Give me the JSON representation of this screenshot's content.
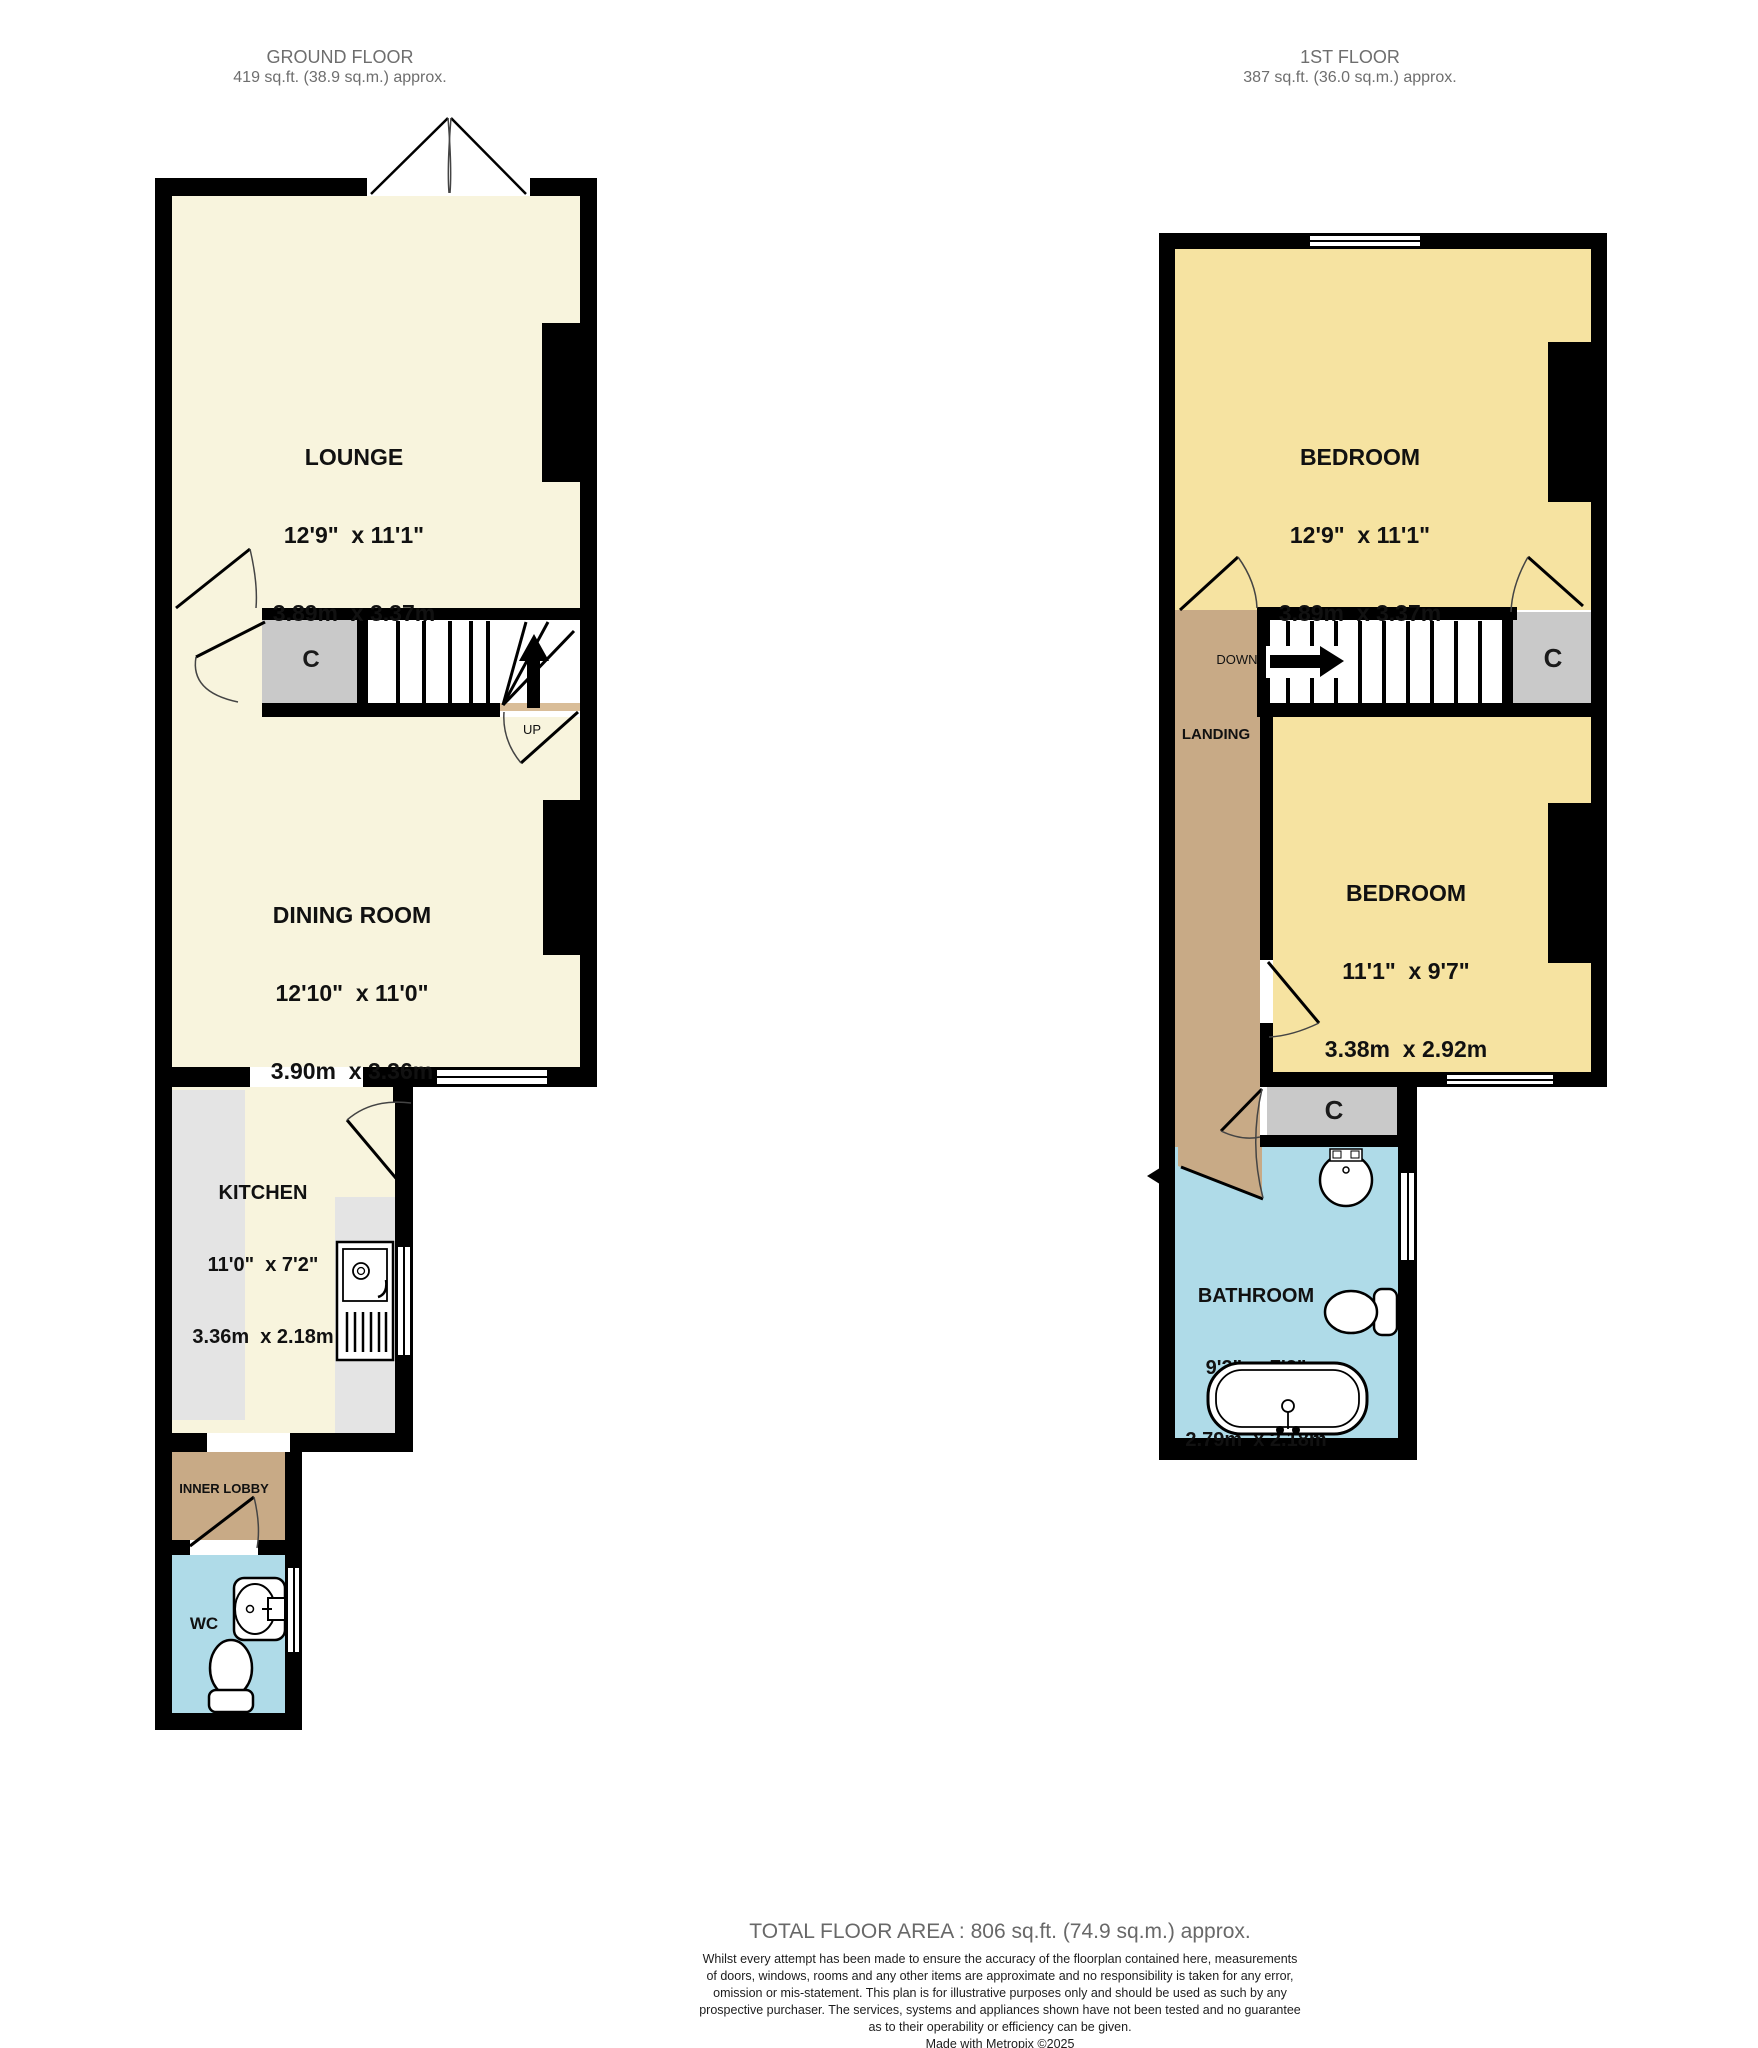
{
  "ground_floor": {
    "title": "GROUND FLOOR",
    "area": "419 sq.ft. (38.9 sq.m.) approx.",
    "lounge": {
      "name": "LOUNGE",
      "imperial": "12'9\"  x 11'1\"",
      "metric": "3.89m  x 3.37m"
    },
    "dining_room": {
      "name": "DINING ROOM",
      "imperial": "12'10\"  x 11'0\"",
      "metric": "3.90m  x 3.36m"
    },
    "kitchen": {
      "name": "KITCHEN",
      "imperial": "11'0\"  x 7'2\"",
      "metric": "3.36m  x 2.18m"
    },
    "inner_lobby": {
      "name": "INNER LOBBY"
    },
    "wc": {
      "name": "WC"
    },
    "cupboard_label": "C",
    "stairs_label": "UP"
  },
  "first_floor": {
    "title": "1ST FLOOR",
    "area": "387 sq.ft. (36.0 sq.m.) approx.",
    "bedroom1": {
      "name": "BEDROOM",
      "imperial": "12'9\"  x 11'1\"",
      "metric": "3.89m  x 3.37m"
    },
    "bedroom2": {
      "name": "BEDROOM",
      "imperial": "11'1\"  x 9'7\"",
      "metric": "3.38m  x 2.92m"
    },
    "bathroom": {
      "name": "BATHROOM",
      "imperial": "9'2\"  x 7'2\"",
      "metric": "2.79m  x 2.18m"
    },
    "landing": {
      "name": "LANDING"
    },
    "stairs_label": "DOWN",
    "cupboard_over_stairs_label": "C",
    "cupboard_landing_label": "C"
  },
  "footer": {
    "total": "TOTAL FLOOR AREA : 806 sq.ft. (74.9 sq.m.) approx.",
    "disclaimer_lines": [
      "Whilst every attempt has been made to ensure the accuracy of the floorplan contained here, measurements",
      "of doors, windows, rooms and any other items are approximate and no responsibility is taken for any error,",
      "omission or mis-statement. This plan is for illustrative purposes only and should be used as such by any",
      "prospective purchaser. The services, systems and appliances shown have not been tested and no guarantee",
      "as to their operability or efficiency can be given."
    ],
    "credit": "Made with Metropix ©2025"
  },
  "colors": {
    "wall": "#000000",
    "ground_rooms": "#f8f4dd",
    "first_rooms": "#f6e3a1",
    "wet_rooms": "#afdbe8",
    "hallways": "#c8aa86",
    "cupboards": "#c9c9c9",
    "kitchen_counters": "#e4e4e4",
    "heading_text": "#6e6e6e"
  }
}
